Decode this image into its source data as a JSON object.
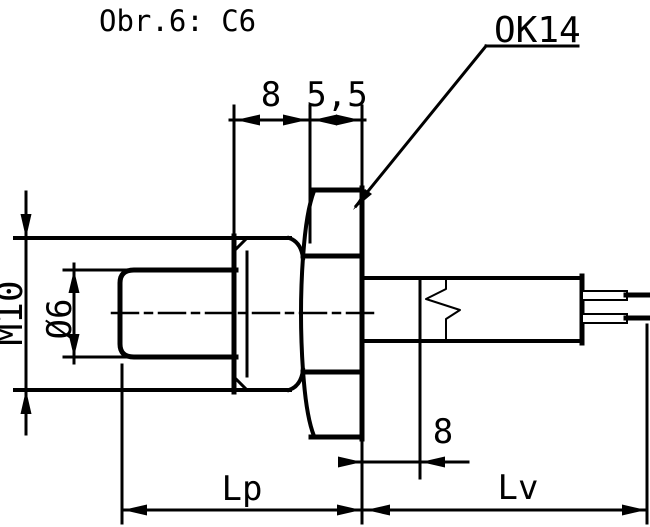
{
  "drawing": {
    "title": "Obr.6: C6",
    "hex_callout": "OK14",
    "dims": {
      "thread_length": "8",
      "hex_thickness": "5,5",
      "thread_size": "M10",
      "tip_diameter": "Ø6",
      "sleeve_length": "8",
      "process_length": "Lp",
      "lead_length": "Lv"
    },
    "colors": {
      "line": "#000000",
      "background": "#ffffff"
    }
  }
}
